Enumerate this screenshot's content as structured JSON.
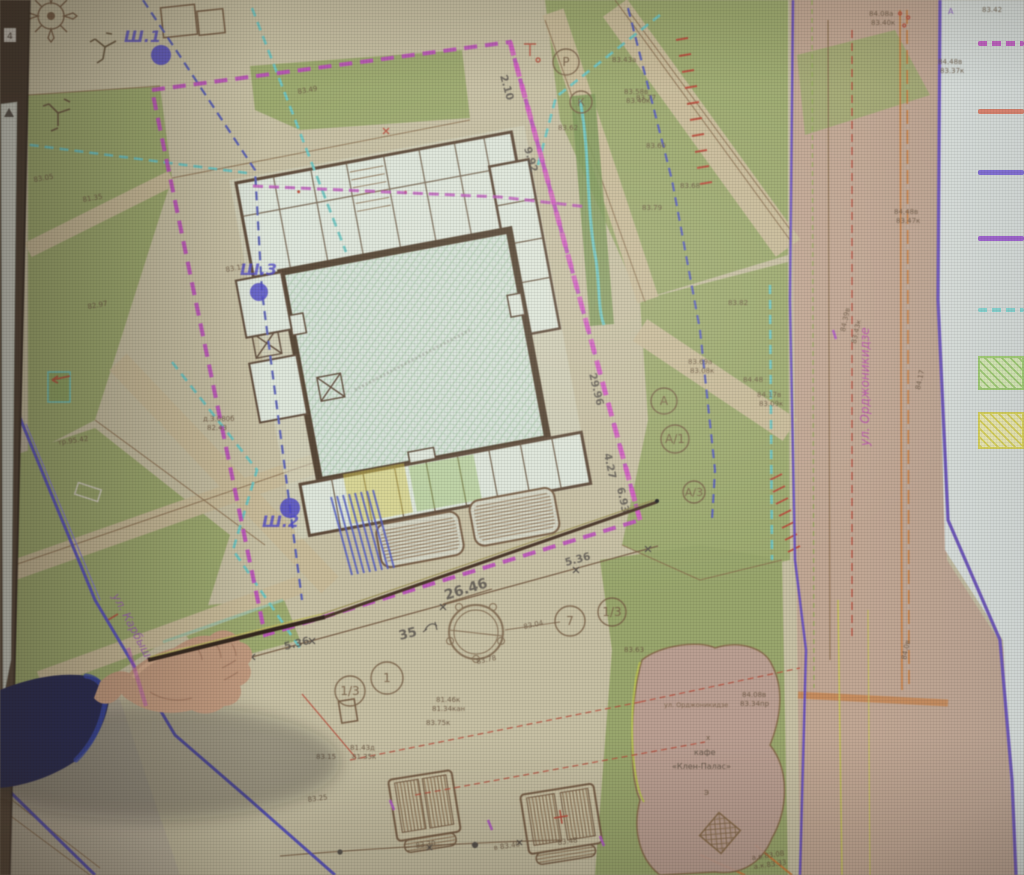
{
  "scene": {
    "left_bar_marker": "4"
  },
  "palette": {
    "spot_text": "#6b5640",
    "dimension_text": "#57524c",
    "borehole": "#4f49cf",
    "axis_text": "#7a6045",
    "magenta_boundary": "#c24ec2",
    "cyan_utility": "#6cc8c4",
    "blue_dashed": "#5a62bc",
    "purple_road": "#6f55c4",
    "lawn_green": "#9dac6c",
    "road_pink": "#c5a893",
    "sheet_margin": "#dde4e0"
  },
  "map": {
    "boreholes": [
      {
        "t": "Ш.1",
        "lx": 124,
        "ly": 42,
        "cx": 161,
        "cy": 55,
        "rad": 10
      },
      {
        "t": "Ш.3",
        "lx": 240,
        "ly": 275,
        "cx": 259,
        "cy": 292,
        "rad": 9
      },
      {
        "t": "Ш.2",
        "lx": 262,
        "ly": 527,
        "cx": 290,
        "cy": 508,
        "rad": 10
      }
    ],
    "axis_bubbles": [
      {
        "t": "Р",
        "x": 566,
        "y": 62,
        "rad": 13
      },
      {
        "t": "К",
        "x": 581,
        "y": 102,
        "rad": 11
      },
      {
        "t": "А",
        "x": 664,
        "y": 401,
        "rad": 13
      },
      {
        "t": "А/1",
        "x": 675,
        "y": 439,
        "rad": 14
      },
      {
        "t": "А/3",
        "x": 694,
        "y": 492,
        "rad": 11
      },
      {
        "t": "7",
        "x": 570,
        "y": 621,
        "rad": 15
      },
      {
        "t": "1/3",
        "x": 612,
        "y": 612,
        "rad": 14
      },
      {
        "t": "1",
        "x": 387,
        "y": 678,
        "rad": 16
      },
      {
        "t": "1/3",
        "x": 350,
        "y": 691,
        "rad": 15
      }
    ],
    "dimensions": [
      {
        "t": "2.10",
        "x": 500,
        "y": 76,
        "r": 74
      },
      {
        "t": "9.92",
        "x": 524,
        "y": 148,
        "r": 74
      },
      {
        "t": "29.96",
        "x": 589,
        "y": 374,
        "r": 76
      },
      {
        "t": "4.27",
        "x": 604,
        "y": 454,
        "r": 78
      },
      {
        "t": "6.93",
        "x": 617,
        "y": 488,
        "r": 78
      },
      {
        "t": "26.46",
        "x": 446,
        "y": 600,
        "r": -17,
        "size": 14
      },
      {
        "t": "5.36",
        "x": 566,
        "y": 566,
        "r": -15
      },
      {
        "t": "5.36",
        "x": 285,
        "y": 650,
        "r": -14
      },
      {
        "t": "35",
        "x": 400,
        "y": 640,
        "r": -14,
        "size": 13
      }
    ],
    "streets": [
      {
        "t": "ул. Орджоникидзе",
        "x": 869,
        "y": 446,
        "r": -90,
        "size": 12,
        "color": "#c04ab4"
      },
      {
        "t": "ул. Карбышева",
        "x": 112,
        "y": 596,
        "r": 62,
        "size": 11.5,
        "color": "#a15ec0"
      }
    ],
    "cafe_labels": [
      {
        "t": "ул. Орджоникидзе",
        "x": 664,
        "y": 707,
        "size": 6.5,
        "color": "#7a5f45"
      },
      {
        "t": "х",
        "x": 706,
        "y": 740,
        "size": 7,
        "color": "#6b5640"
      },
      {
        "t": "кафе",
        "x": 694,
        "y": 755,
        "size": 8,
        "color": "#5f5143"
      },
      {
        "t": "«Клен-Палас»",
        "x": 672,
        "y": 769,
        "size": 8,
        "color": "#5f5143"
      },
      {
        "t": "Э",
        "x": 704,
        "y": 795,
        "size": 7,
        "color": "#6b5640"
      }
    ],
    "misc_labels": [
      {
        "t": "4",
        "x": 7,
        "y": 39,
        "size": 9,
        "color": "#3a3028"
      },
      {
        "t": "А",
        "x": 948,
        "y": 14,
        "size": 8,
        "color": "#8a55c8"
      }
    ],
    "spot_elevations": [
      {
        "t": "83.42",
        "x": 982,
        "y": 12
      },
      {
        "t": "84.48в",
        "x": 938,
        "y": 64
      },
      {
        "t": "83.37к",
        "x": 940,
        "y": 73
      },
      {
        "t": "84.08а",
        "x": 869,
        "y": 16
      },
      {
        "t": "83.40к",
        "x": 871,
        "y": 25
      },
      {
        "t": "84.39в",
        "x": 845,
        "y": 332,
        "r": -78
      },
      {
        "t": "83.43к",
        "x": 856,
        "y": 344,
        "r": -78
      },
      {
        "t": "84.0в",
        "x": 906,
        "y": 660,
        "r": -78
      },
      {
        "t": "84.17",
        "x": 920,
        "y": 390,
        "r": -78
      },
      {
        "t": "83.49",
        "x": 298,
        "y": 94,
        "r": -10
      },
      {
        "t": "83.43а",
        "x": 612,
        "y": 62
      },
      {
        "t": "83.58в",
        "x": 624,
        "y": 94
      },
      {
        "t": "83.40к",
        "x": 626,
        "y": 103
      },
      {
        "t": "83.60",
        "x": 646,
        "y": 148
      },
      {
        "t": "83.68",
        "x": 680,
        "y": 188
      },
      {
        "t": "83.79",
        "x": 642,
        "y": 210
      },
      {
        "t": "83.62",
        "x": 558,
        "y": 130
      },
      {
        "t": "83.77",
        "x": 636,
        "y": 100
      },
      {
        "t": "83.17",
        "x": 226,
        "y": 272,
        "r": -10
      },
      {
        "t": "82.97",
        "x": 88,
        "y": 309,
        "r": -10
      },
      {
        "t": "83.05",
        "x": 34,
        "y": 182,
        "r": -10
      },
      {
        "t": "81.35",
        "x": 83,
        "y": 202,
        "r": -10
      },
      {
        "t": "д.3.080б",
        "x": 203,
        "y": 421
      },
      {
        "t": "82.43",
        "x": 207,
        "y": 430
      },
      {
        "t": "83.69а",
        "x": 688,
        "y": 364
      },
      {
        "t": "83.08к",
        "x": 690,
        "y": 373
      },
      {
        "t": "84.48",
        "x": 743,
        "y": 382
      },
      {
        "t": "84.17в",
        "x": 757,
        "y": 397
      },
      {
        "t": "83.09к",
        "x": 759,
        "y": 406
      },
      {
        "t": "83.82",
        "x": 728,
        "y": 305
      },
      {
        "t": "83.04",
        "x": 524,
        "y": 629,
        "r": -12
      },
      {
        "t": "83.78",
        "x": 477,
        "y": 664,
        "r": -12
      },
      {
        "t": "83.63",
        "x": 624,
        "y": 652
      },
      {
        "t": "81.46к",
        "x": 436,
        "y": 702
      },
      {
        "t": "81.34кан",
        "x": 432,
        "y": 711
      },
      {
        "t": "83.75к",
        "x": 426,
        "y": 725
      },
      {
        "t": "83.15",
        "x": 316,
        "y": 759
      },
      {
        "t": "83.25",
        "x": 308,
        "y": 802,
        "r": -8
      },
      {
        "t": "81.43д",
        "x": 350,
        "y": 750
      },
      {
        "t": "81.35к",
        "x": 352,
        "y": 759
      },
      {
        "t": "в 83.40",
        "x": 494,
        "y": 850,
        "r": -8
      },
      {
        "t": "83.48",
        "x": 558,
        "y": 845,
        "r": -8
      },
      {
        "t": "83.30",
        "x": 416,
        "y": 848,
        "r": -8
      },
      {
        "t": "84.08в",
        "x": 742,
        "y": 697
      },
      {
        "t": "83.34пр",
        "x": 740,
        "y": 706
      },
      {
        "t": "а.в.83.08",
        "x": 752,
        "y": 860,
        "r": -8
      },
      {
        "t": "а.к.83.33",
        "x": 754,
        "y": 869,
        "r": -8
      },
      {
        "t": "84.48в",
        "x": 894,
        "y": 214
      },
      {
        "t": "83.47к",
        "x": 896,
        "y": 223
      },
      {
        "t": "тр.95.42",
        "x": 58,
        "y": 445,
        "r": -8
      }
    ]
  },
  "legend": {
    "items": [
      {
        "name": "site-boundary-line",
        "style": "dashed",
        "color": "#c653c6",
        "y": 41,
        "h": 5
      },
      {
        "name": "red-utility-line",
        "style": "solid",
        "color": "#e07a62",
        "y": 109,
        "h": 5
      },
      {
        "name": "blue-violet-line",
        "style": "solid",
        "color": "#7a63d8",
        "y": 170,
        "h": 5
      },
      {
        "name": "purple-line",
        "style": "solid",
        "color": "#9a55d0",
        "y": 236,
        "h": 5
      },
      {
        "name": "cyan-dashed-line",
        "style": "dashed",
        "color": "#7ed8d4",
        "y": 308,
        "h": 4
      },
      {
        "name": "green-hatch-area",
        "style": "hatch",
        "color": "#9ed06a",
        "fill": "#dcefb6",
        "y": 356,
        "h": 34
      },
      {
        "name": "yellow-hatch-area",
        "style": "hatch",
        "color": "#ded64e",
        "fill": "#f2eeb2",
        "y": 412,
        "h": 37
      }
    ]
  }
}
